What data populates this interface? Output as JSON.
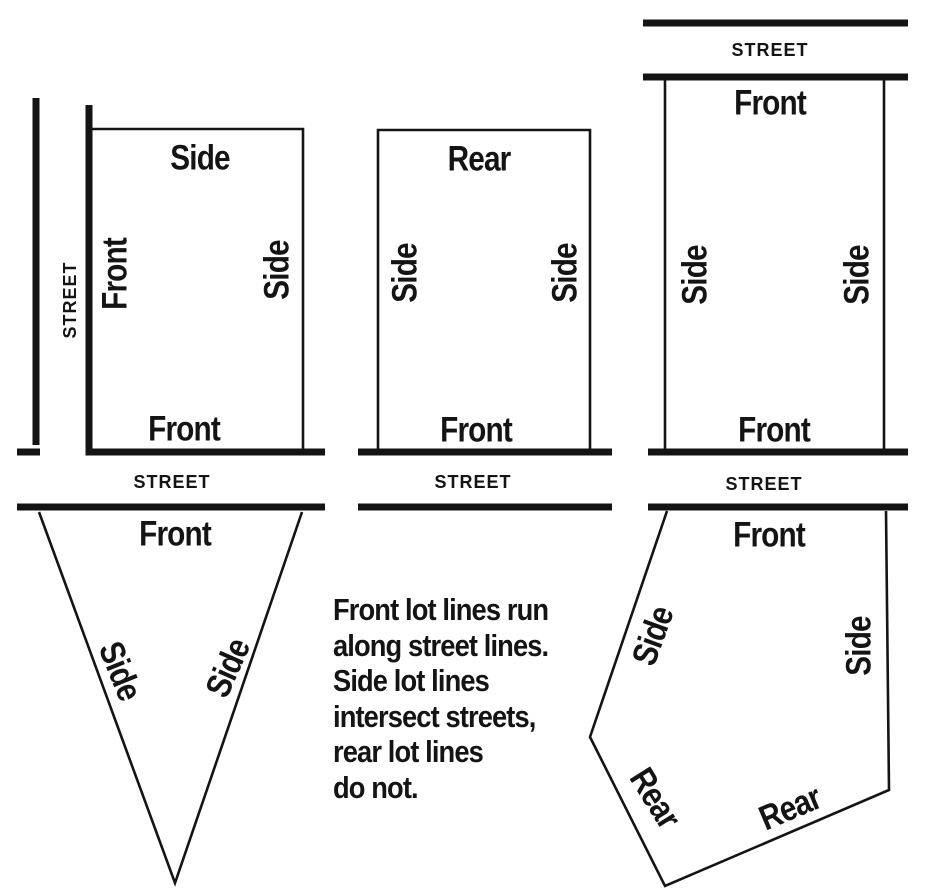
{
  "streets": {
    "west_label": "STREET",
    "south_left_label": "STREET",
    "south_center_label": "STREET",
    "north_right_label": "STREET",
    "south_right_label": "STREET"
  },
  "lots": {
    "corner": {
      "top": "Side",
      "left": "Front",
      "right": "Side",
      "bottom": "Front"
    },
    "interior": {
      "top": "Rear",
      "left": "Side",
      "right": "Side",
      "bottom": "Front"
    },
    "through": {
      "top": "Front",
      "left": "Side",
      "right": "Side",
      "bottom": "Front"
    },
    "triangle": {
      "top": "Front",
      "left": "Side",
      "right": "Side"
    },
    "pentagon": {
      "top": "Front",
      "left": "Side",
      "right": "Side",
      "rear_left": "Rear",
      "rear_right": "Rear"
    }
  },
  "caption": {
    "lines": [
      "Front lot lines run",
      "along street lines.",
      "Side lot lines",
      "intersect streets,",
      "rear lot lines",
      "do not."
    ]
  },
  "colors": {
    "ink": "#141414",
    "paper": "#ffffff"
  }
}
